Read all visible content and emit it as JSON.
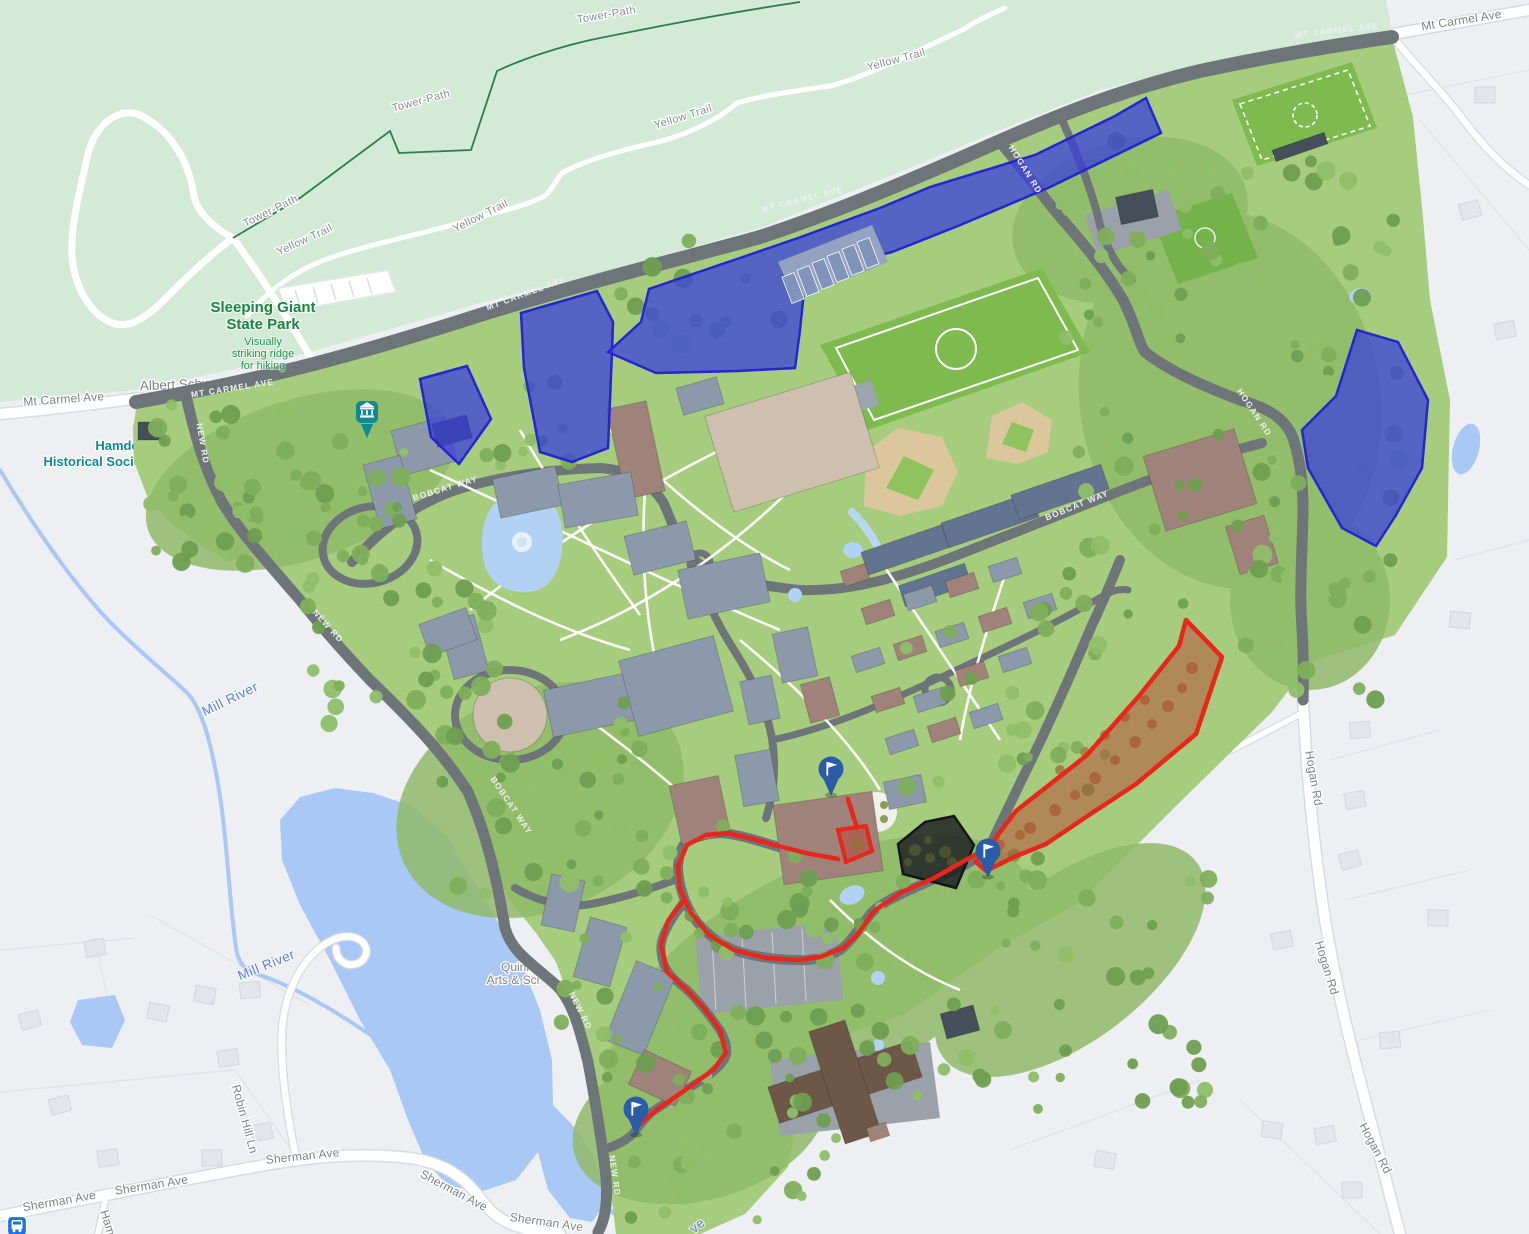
{
  "map": {
    "colors": {
      "offcampus_bg": "#edeff3",
      "park_green": "#d2ead6",
      "campus_green": "#a6cd7e",
      "water": "#a9c8f6",
      "road_dark": "#6e7579",
      "road_white": "#ffffff",
      "parking_overlay_fill": "#3a3fd9",
      "parking_overlay_stroke": "#2526cf",
      "route_red": "#e8271c",
      "red_lot_fill": "rgba(185,70,50,0.5)",
      "black_area_fill": "rgba(28,28,33,0.82)",
      "flag_marker_blue": "#2a5da6",
      "museum_pin_teal": "#0d8a96",
      "transit_blue": "#1a73e8"
    },
    "labels": [
      {
        "id": "park-name-line1",
        "text": "Sleeping Giant",
        "x": 263,
        "y": 312,
        "rot": 0,
        "cls": "park-title"
      },
      {
        "id": "park-name-line2",
        "text": "State Park",
        "x": 263,
        "y": 329,
        "rot": 0,
        "cls": "park-title"
      },
      {
        "id": "park-desc-line1",
        "text": "Visually",
        "x": 263,
        "y": 345,
        "rot": 0,
        "cls": "park-sub"
      },
      {
        "id": "park-desc-line2",
        "text": "striking ridge",
        "x": 263,
        "y": 357,
        "rot": 0,
        "cls": "park-sub"
      },
      {
        "id": "park-desc-line3",
        "text": "for hiking",
        "x": 263,
        "y": 369,
        "rot": 0,
        "cls": "park-sub"
      },
      {
        "id": "tower-path-label-1",
        "text": "Tower-Path",
        "x": 607,
        "y": 18,
        "rot": -10,
        "cls": "trail"
      },
      {
        "id": "tower-path-label-2",
        "text": "Tower-Path",
        "x": 422,
        "y": 104,
        "rot": -15,
        "cls": "trail"
      },
      {
        "id": "tower-path-label-3",
        "text": "Tower-Path",
        "x": 272,
        "y": 214,
        "rot": -26,
        "cls": "trail"
      },
      {
        "id": "yellow-trail-label-1",
        "text": "Yellow Trail",
        "x": 306,
        "y": 243,
        "rot": -25,
        "cls": "trail"
      },
      {
        "id": "yellow-trail-label-2",
        "text": "Yellow Trail",
        "x": 482,
        "y": 219,
        "rot": -27,
        "cls": "trail"
      },
      {
        "id": "yellow-trail-label-3",
        "text": "Yellow Trail",
        "x": 684,
        "y": 120,
        "rot": -17,
        "cls": "trail"
      },
      {
        "id": "yellow-trail-label-4",
        "text": "Yellow Trail",
        "x": 897,
        "y": 63,
        "rot": -15,
        "cls": "trail"
      },
      {
        "id": "mt-carmel-ave-label-west",
        "text": "Mt Carmel Ave",
        "x": 64,
        "y": 403,
        "rot": -4,
        "cls": "street"
      },
      {
        "id": "mt-carmel-ave-label-east",
        "text": "Mt Carmel Ave",
        "x": 1462,
        "y": 24,
        "rot": -9,
        "cls": "street"
      },
      {
        "id": "hogan-rd-label-1",
        "text": "Hogan Rd",
        "x": 1310,
        "y": 779,
        "rot": 80,
        "cls": "street"
      },
      {
        "id": "hogan-rd-label-2",
        "text": "Hogan Rd",
        "x": 1323,
        "y": 969,
        "rot": 73,
        "cls": "street"
      },
      {
        "id": "hogan-rd-label-3",
        "text": "Hogan Rd",
        "x": 1372,
        "y": 1150,
        "rot": 62,
        "cls": "street"
      },
      {
        "id": "sherman-ave-label-1",
        "text": "Sherman Ave",
        "x": 60,
        "y": 1205,
        "rot": -10,
        "cls": "street"
      },
      {
        "id": "sherman-ave-label-2",
        "text": "Sherman Ave",
        "x": 152,
        "y": 1189,
        "rot": -9,
        "cls": "street"
      },
      {
        "id": "sherman-ave-label-3",
        "text": "Sherman Ave",
        "x": 303,
        "y": 1160,
        "rot": -6,
        "cls": "street"
      },
      {
        "id": "sherman-ave-label-4",
        "text": "Sherman Ave",
        "x": 452,
        "y": 1194,
        "rot": 28,
        "cls": "street"
      },
      {
        "id": "sherman-ave-label-5",
        "text": "Sherman Ave",
        "x": 546,
        "y": 1226,
        "rot": 8,
        "cls": "street"
      },
      {
        "id": "robin-hill-ln-label",
        "text": "Robin Hill Ln",
        "x": 241,
        "y": 1120,
        "rot": 75,
        "cls": "street"
      },
      {
        "id": "hamden-st-fragment",
        "text": "Ham",
        "x": 104,
        "y": 1224,
        "rot": 72,
        "cls": "street"
      },
      {
        "id": "mill-river-label-1",
        "text": "Mill River",
        "x": 232,
        "y": 703,
        "rot": -26,
        "cls": "water"
      },
      {
        "id": "mill-river-label-2",
        "text": "Mill River",
        "x": 268,
        "y": 969,
        "rot": -22,
        "cls": "water"
      },
      {
        "id": "river-label-fragment",
        "text": "ve",
        "x": 700,
        "y": 1229,
        "rot": -38,
        "cls": "water"
      },
      {
        "id": "mt-carmel-road-1",
        "text": "MT CARMEL AVE",
        "x": 233,
        "y": 391,
        "rot": -9,
        "cls": "roadname"
      },
      {
        "id": "mt-carmel-road-2",
        "text": "MT CARMEL AVE",
        "x": 527,
        "y": 296,
        "rot": -20,
        "cls": "roadname"
      },
      {
        "id": "mt-carmel-road-3",
        "text": "MT CARMEL AVE",
        "x": 803,
        "y": 202,
        "rot": -14,
        "cls": "roadname"
      },
      {
        "id": "mt-carmel-road-4",
        "text": "MT CARMEL AVE",
        "x": 1337,
        "y": 33,
        "rot": -7,
        "cls": "roadname"
      },
      {
        "id": "hogan-road-label-1",
        "text": "HOGAN RD",
        "x": 1023,
        "y": 171,
        "rot": 58,
        "cls": "roadname"
      },
      {
        "id": "hogan-road-label-2",
        "text": "HOGAN RD",
        "x": 1252,
        "y": 414,
        "rot": 56,
        "cls": "roadname"
      },
      {
        "id": "new-rd-label-1",
        "text": "NEW RD",
        "x": 200,
        "y": 444,
        "rot": 80,
        "cls": "roadname"
      },
      {
        "id": "new-rd-label-2",
        "text": "NEW RD",
        "x": 326,
        "y": 628,
        "rot": 48,
        "cls": "roadname"
      },
      {
        "id": "new-rd-label-3",
        "text": "NEW RD",
        "x": 578,
        "y": 1012,
        "rot": 63,
        "cls": "roadname"
      },
      {
        "id": "new-rd-label-4",
        "text": "NEW RD",
        "x": 612,
        "y": 1176,
        "rot": 82,
        "cls": "roadname"
      },
      {
        "id": "bobcat-way-label-1",
        "text": "BOBCAT WAY",
        "x": 446,
        "y": 491,
        "rot": -17,
        "cls": "roadname"
      },
      {
        "id": "bobcat-way-label-2",
        "text": "BOBCAT WAY",
        "x": 509,
        "y": 807,
        "rot": 56,
        "cls": "roadname"
      },
      {
        "id": "bobcat-way-label-3",
        "text": "BOBCAT WAY",
        "x": 1078,
        "y": 508,
        "rot": -22,
        "cls": "roadname"
      },
      {
        "id": "hamden-historical-line1",
        "text": "Hamden",
        "x": 121,
        "y": 450,
        "rot": 0,
        "cls": "poi-teal",
        "layer": "under"
      },
      {
        "id": "hamden-historical-line2",
        "text": "Historical Society",
        "x": 98,
        "y": 466,
        "rot": 0,
        "cls": "poi-teal",
        "layer": "under"
      },
      {
        "id": "albert-schweitzer-label",
        "text": "Albert Schw",
        "x": 176,
        "y": 389,
        "rot": -2,
        "cls": "poi-gray-lg",
        "layer": "under"
      },
      {
        "id": "quinnipiac-label-line1",
        "text": "Quinn",
        "x": 517,
        "y": 971,
        "rot": 0,
        "cls": "poi-gray",
        "layer": "under"
      },
      {
        "id": "quinnipiac-label-line2",
        "text": "Arts & Sci",
        "x": 513,
        "y": 984,
        "rot": 0,
        "cls": "poi-gray",
        "layer": "under"
      }
    ],
    "markers": {
      "flags": [
        {
          "id": "flag-marker-1",
          "x": 831,
          "y": 769
        },
        {
          "id": "flag-marker-2",
          "x": 988,
          "y": 851
        },
        {
          "id": "flag-marker-3",
          "x": 636,
          "y": 1109
        }
      ],
      "museum_pin": {
        "id": "museum-pin",
        "x": 367,
        "y": 416
      },
      "transit_stop": {
        "id": "transit-stop-icon",
        "x": 17,
        "y": 1226
      }
    },
    "overlays": {
      "blue_parking_lots": [
        [
          [
            420,
            379
          ],
          [
            467,
            366
          ],
          [
            491,
            419
          ],
          [
            459,
            464
          ],
          [
            431,
            437
          ]
        ],
        [
          [
            521,
            313
          ],
          [
            597,
            291
          ],
          [
            613,
            322
          ],
          [
            612,
            352
          ],
          [
            608,
            448
          ],
          [
            572,
            462
          ],
          [
            540,
            452
          ],
          [
            524,
            368
          ]
        ],
        [
          [
            608,
            352
          ],
          [
            641,
            322
          ],
          [
            649,
            289
          ],
          [
            737,
            259
          ],
          [
            798,
            238
          ],
          [
            880,
            208
          ],
          [
            930,
            187
          ],
          [
            1035,
            155
          ],
          [
            1115,
            116
          ],
          [
            1146,
            98
          ],
          [
            1161,
            133
          ],
          [
            1048,
            188
          ],
          [
            958,
            226
          ],
          [
            892,
            252
          ],
          [
            830,
            268
          ],
          [
            806,
            272
          ],
          [
            800,
            330
          ],
          [
            795,
            368
          ],
          [
            737,
            371
          ],
          [
            656,
            373
          ]
        ],
        [
          [
            1357,
            330
          ],
          [
            1398,
            342
          ],
          [
            1428,
            400
          ],
          [
            1422,
            468
          ],
          [
            1396,
            515
          ],
          [
            1376,
            546
          ],
          [
            1342,
            528
          ],
          [
            1308,
            468
          ],
          [
            1302,
            430
          ],
          [
            1336,
            396
          ]
        ]
      ],
      "red_parking_lot": [
        [
          1186,
          620
        ],
        [
          1222,
          657
        ],
        [
          1196,
          734
        ],
        [
          1136,
          784
        ],
        [
          1086,
          817
        ],
        [
          1046,
          844
        ],
        [
          1014,
          857
        ],
        [
          986,
          871
        ],
        [
          976,
          862
        ],
        [
          988,
          848
        ],
        [
          1016,
          811
        ],
        [
          1086,
          756
        ],
        [
          1139,
          696
        ],
        [
          1179,
          646
        ]
      ],
      "red_area_small": [
        [
          838,
          830
        ],
        [
          866,
          826
        ],
        [
          872,
          851
        ],
        [
          846,
          862
        ]
      ],
      "black_area": [
        [
          925,
          822
        ],
        [
          954,
          816
        ],
        [
          974,
          845
        ],
        [
          956,
          888
        ],
        [
          903,
          874
        ],
        [
          898,
          844
        ]
      ],
      "red_route_paths": [
        [
          [
            992,
            845
          ],
          [
            966,
            860
          ],
          [
            934,
            878
          ],
          [
            902,
            892
          ],
          [
            874,
            911
          ],
          [
            858,
            934
          ],
          [
            843,
            948
          ],
          [
            820,
            957
          ],
          [
            798,
            960
          ],
          [
            766,
            958
          ],
          [
            734,
            950
          ],
          [
            709,
            935
          ],
          [
            691,
            913
          ],
          [
            680,
            889
          ],
          [
            678,
            866
          ],
          [
            687,
            845
          ],
          [
            706,
            835
          ],
          [
            728,
            833
          ],
          [
            753,
            839
          ],
          [
            778,
            846
          ],
          [
            806,
            853
          ],
          [
            838,
            859
          ]
        ],
        [
          [
            684,
            900
          ],
          [
            668,
            921
          ],
          [
            661,
            945
          ],
          [
            667,
            972
          ],
          [
            686,
            989
          ],
          [
            703,
            1007
          ],
          [
            720,
            1030
          ],
          [
            726,
            1053
          ],
          [
            713,
            1070
          ],
          [
            681,
            1093
          ],
          [
            655,
            1111
          ],
          [
            640,
            1124
          ]
        ],
        [
          [
            857,
            828
          ],
          [
            848,
            799
          ]
        ]
      ]
    }
  }
}
